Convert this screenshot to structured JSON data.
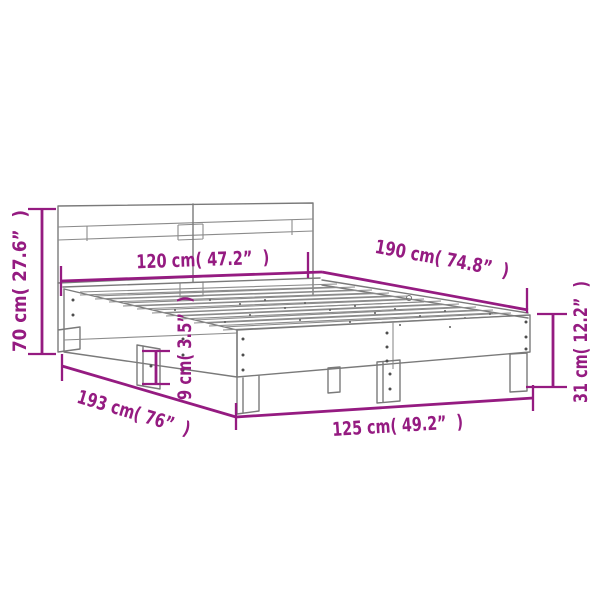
{
  "title": "Bed frame with headboard dimensions diagram",
  "colors": {
    "accent": "#951B81",
    "line_art": "#7A7A7A",
    "background": "#FFFFFF"
  },
  "dims": {
    "width_mattress": {
      "label": "120 cm( 47.2”  )",
      "cm": 120,
      "inches": 47.2
    },
    "length_mattress": {
      "label": "190 cm( 74.8”  )",
      "cm": 190,
      "inches": 74.8
    },
    "height_total": {
      "label": "70 cm( 27.6”  )",
      "cm": 70,
      "inches": 27.6
    },
    "clearance": {
      "label": "9 cm( 3.5”  )",
      "cm": 9,
      "inches": 3.5
    },
    "length_total": {
      "label": "193 cm( 76”  )",
      "cm": 193,
      "inches": 76
    },
    "width_total": {
      "label": "125 cm( 49.2”  )",
      "cm": 125,
      "inches": 49.2
    },
    "height_side": {
      "label": "31 cm( 12.2”  )",
      "cm": 31,
      "inches": 12.2
    }
  }
}
